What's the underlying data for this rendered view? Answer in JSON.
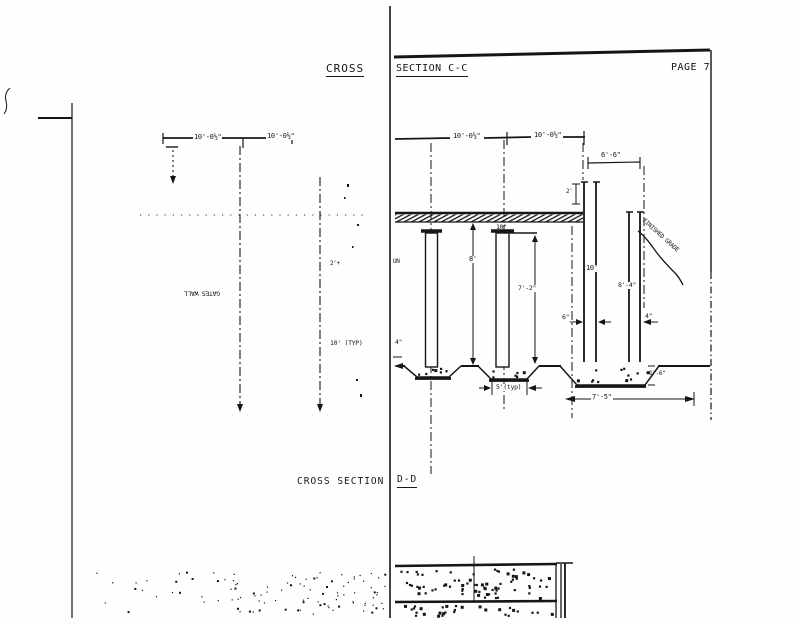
{
  "titles": {
    "cross": "CROSS",
    "section_cc": "SECTION C-C",
    "page": "PAGE 7",
    "cross_section": "CROSS SECTION",
    "section_dd": "D-D"
  },
  "left_view": {
    "dim_span1": "10'-0½\"",
    "dim_span2": "10'-0½\"",
    "wall_label": "GATES WALL",
    "dim_2plus": "2'+",
    "dim_typ": "10' (TYP)"
  },
  "section_cc": {
    "dim_span1": "10'-0½\"",
    "dim_span2": "10'-0½\"",
    "dim_6_6": "6'-6\"",
    "dim_2ft": "2'",
    "dim_10in": "10\"",
    "label_un": "UN",
    "dim_8ft": "8'",
    "dim_7_2": "7'-2\"",
    "dim_10ft": "10'",
    "dim_8_4": "8'-4\"",
    "grade_label": "FINISHED GRADE",
    "dim_6in": "6\"",
    "dim_4in": "4\"",
    "dim_4in_left": "4\"",
    "dim_5typ": "5'(typ)",
    "dim_7_5": "7'-5\"",
    "dim_1_6": "1'-6\""
  },
  "ink": "#161616"
}
